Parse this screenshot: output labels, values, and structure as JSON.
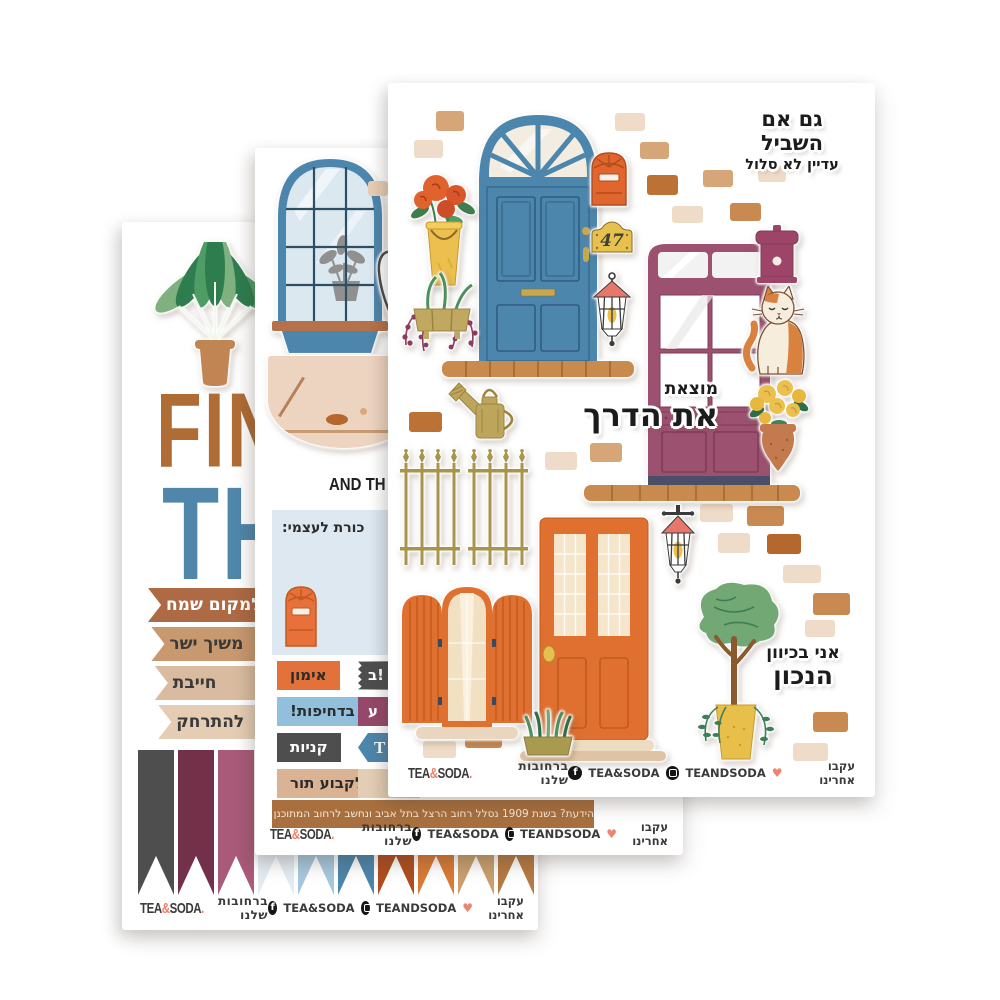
{
  "palette": {
    "door_blue": "#4d86ac",
    "door_purple": "#9d5170",
    "door_orange": "#e0702f",
    "accent_coral": "#ee7f66",
    "lantern_coral": "#e8766a",
    "olive_gold": "#a8954a",
    "yellow": "#ecbf4e",
    "leaf_green": "#72a873",
    "dark_gray": "#4e4e4e",
    "light_blue_label": "#92c0dc",
    "banner_brown": "#a9703f"
  },
  "footer": {
    "logo_tea": "TEA",
    "logo_amp": "&",
    "logo_soda": "SODA",
    "logo_dot": ".",
    "center": "ברחובות שלנו",
    "facebook_glyph": "f",
    "facebook_label": "TEA&SODA",
    "instagram_label": "TEANDSODA",
    "heart": "♥",
    "follow": "עקבו אחרינו"
  },
  "front_sheet": {
    "title_line1": "גם אם השביל",
    "title_line2": "עדיין לא סלול",
    "mid_text_line1": "מוצאת",
    "mid_text_line2": "את הדרך",
    "bottom_text_line1": "אני בכיוון",
    "bottom_text_line2": "הנכון",
    "house_number": "47",
    "brick_colors": [
      "#d7a678",
      "#eedcc8",
      "#bd7235",
      "#c98a52",
      "#b5672d"
    ],
    "bricks": [
      [
        48,
        28,
        28,
        20,
        0
      ],
      [
        26,
        57,
        29,
        18,
        1
      ],
      [
        227,
        30,
        30,
        18,
        1
      ],
      [
        252,
        59,
        29,
        17,
        0
      ],
      [
        259,
        92,
        31,
        20,
        2
      ],
      [
        315,
        87,
        30,
        17,
        0
      ],
      [
        370,
        83,
        28,
        16,
        1
      ],
      [
        284,
        123,
        31,
        17,
        1
      ],
      [
        342,
        120,
        31,
        18,
        3
      ],
      [
        21,
        329,
        33,
        20,
        2
      ],
      [
        157,
        369,
        32,
        18,
        1
      ],
      [
        202,
        360,
        32,
        19,
        0
      ],
      [
        312,
        421,
        33,
        18,
        1
      ],
      [
        359,
        423,
        37,
        20,
        3
      ],
      [
        330,
        450,
        32,
        20,
        1
      ],
      [
        379,
        451,
        34,
        20,
        4
      ],
      [
        395,
        482,
        38,
        18,
        1
      ],
      [
        425,
        510,
        37,
        22,
        3
      ],
      [
        417,
        537,
        30,
        17,
        1
      ],
      [
        425,
        629,
        35,
        20,
        3
      ],
      [
        405,
        660,
        35,
        18,
        1
      ],
      [
        35,
        658,
        33,
        17,
        1
      ],
      [
        77,
        645,
        37,
        20,
        3
      ]
    ]
  },
  "middle_sheet": {
    "english_fragment": "AND TH",
    "note_fragment": "כורת לעצמי:",
    "labels": [
      {
        "text": "אימון",
        "bg": "#e2713a",
        "color": "#2b2b2b"
      },
      {
        "text": "בדחיפות!",
        "bg": "#92c0dc",
        "color": "#2b2b2b"
      },
      {
        "text": "קניות",
        "bg": "#4e4e4e",
        "color": "#ffffff"
      },
      {
        "text": "לקבוע תור",
        "bg": "#d9b393",
        "color": "#2b2b2b"
      }
    ],
    "partials": {
      "p1": "ב!",
      "p2": "ע",
      "p3": "T",
      "p4": ""
    },
    "info_banner": "הידעת? בשנת 1909 נסלל רחוב הרצל בתל אביב ונחשב לרחוב המתוכנן הראשון של העיר העברית ראשונה"
  },
  "back_sheet": {
    "word_fragment1": "FIN",
    "word_fragment2": "TH",
    "ribbons": [
      {
        "text": "תי למקום שמח",
        "bg": "#ad6a44",
        "color": "#ffffff"
      },
      {
        "text": "משיך ישר",
        "bg": "#c8986e",
        "color": "#3a3a3a"
      },
      {
        "text": "חייבת",
        "bg": "#d9bb9f",
        "color": "#3a3a3a"
      },
      {
        "text": "להתרחק",
        "bg": "#e4cdb4",
        "color": "#3a3a3a"
      }
    ],
    "flags": [
      "#4e4e4e",
      "#733049",
      "#a85a78",
      "#e3ebf1",
      "#a6c8de",
      "#4d86ab",
      "#b04e20",
      "#d97b36",
      "#c9a06e",
      "#b57a42"
    ]
  }
}
